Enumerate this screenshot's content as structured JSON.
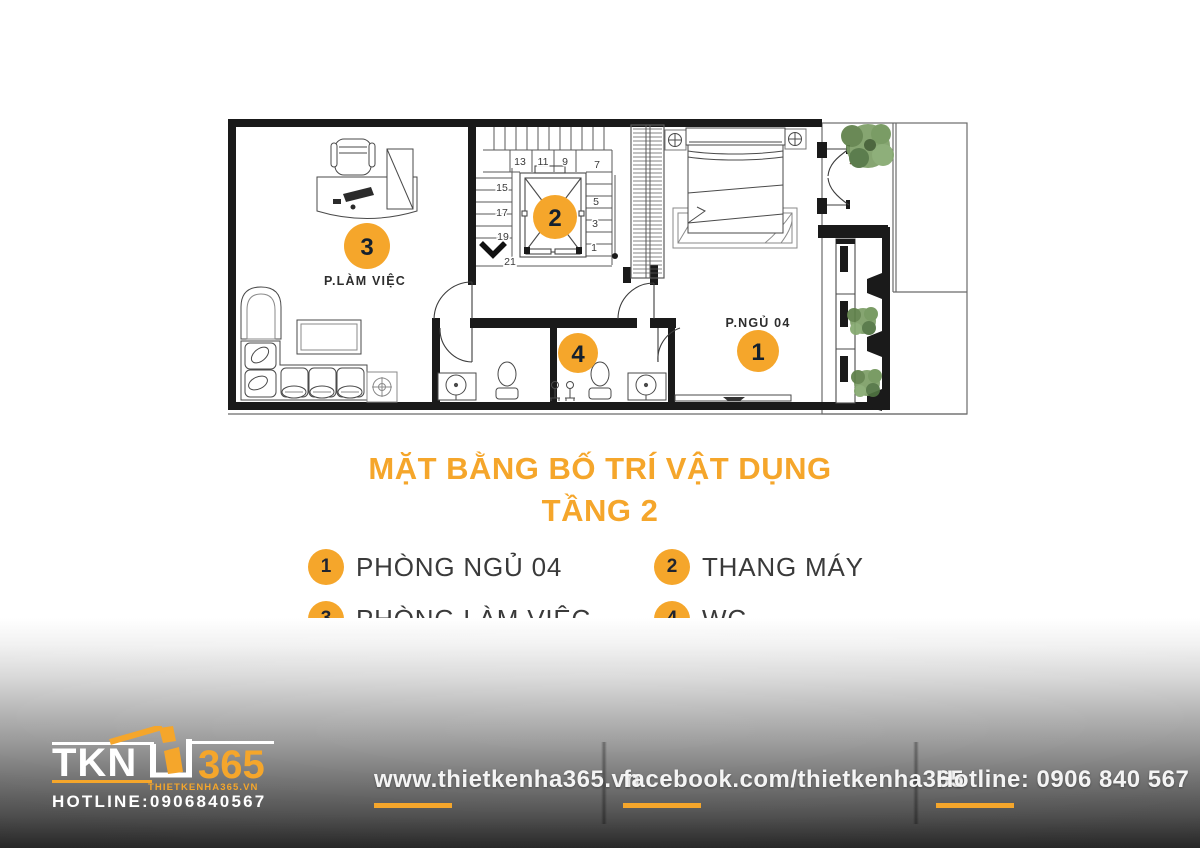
{
  "colors": {
    "accent": "#F5A62B",
    "wall": "#1A1A1A",
    "legend_text": "#3A3A3A",
    "footer_text": "#F4F4F4"
  },
  "plan": {
    "rooms": {
      "office": "P.LÀM VIỆC",
      "bedroom": "P.NGỦ 04"
    },
    "markers": [
      {
        "num": "1"
      },
      {
        "num": "2"
      },
      {
        "num": "3"
      },
      {
        "num": "4"
      }
    ],
    "stair_numbers": [
      "13",
      "11",
      "9",
      "7",
      "15",
      "17",
      "19",
      "21",
      "5",
      "3",
      "1"
    ]
  },
  "title": {
    "line1": "MẶT BẰNG BỐ TRÍ VẬT DỤNG",
    "line2": "TẦNG 2"
  },
  "legend": [
    {
      "num": "1",
      "label": "PHÒNG NGỦ 04"
    },
    {
      "num": "2",
      "label": "THANG MÁY"
    },
    {
      "num": "3",
      "label": "PHÒNG LÀM VIỆC"
    },
    {
      "num": "4",
      "label": "WC"
    }
  ],
  "footer": {
    "logo": {
      "name": "TKN",
      "suffix": "365",
      "domain": "THIETKENHA365.VN",
      "hotline": "HOTLINE:0906840567"
    },
    "links": [
      {
        "text": "www.thietkenha365.vn"
      },
      {
        "text": "facebook.com/thietkenha365"
      },
      {
        "text": "Hotline: 0906 840 567"
      }
    ]
  }
}
